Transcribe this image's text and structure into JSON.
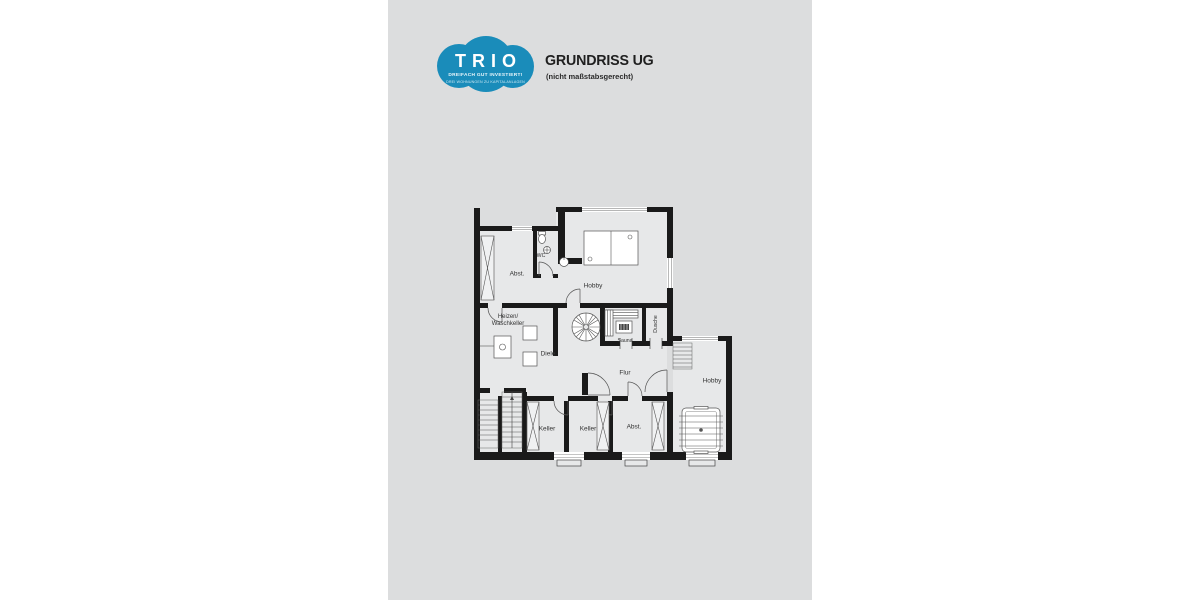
{
  "colors": {
    "accent_blue": "#1a8cba",
    "panel_gray": "#dcddde",
    "wall_black": "#1a1a1a",
    "room_gray": "#e7e8e9"
  },
  "logo": {
    "brand": "TRIO",
    "tagline1": "DREIFACH GUT INVESTIERT!",
    "tagline2": "DREI WOHNUNGEN ZU KAPITALANLAGEN"
  },
  "header": {
    "title": "GRUNDRISS UG",
    "subtitle": "(nicht maßstabsgerecht)"
  },
  "floorplan": {
    "rooms": [
      {
        "label": "Abst."
      },
      {
        "label": "WC"
      },
      {
        "label": "Hobby"
      },
      {
        "label": "Heizen/\nWaschkeller"
      },
      {
        "label": "Diele"
      },
      {
        "label": "Sauna"
      },
      {
        "label": "Dusche"
      },
      {
        "label": "Flur"
      },
      {
        "label": "Hobby"
      },
      {
        "label": "Keller"
      },
      {
        "label": "Keller"
      },
      {
        "label": "Abst."
      }
    ]
  }
}
